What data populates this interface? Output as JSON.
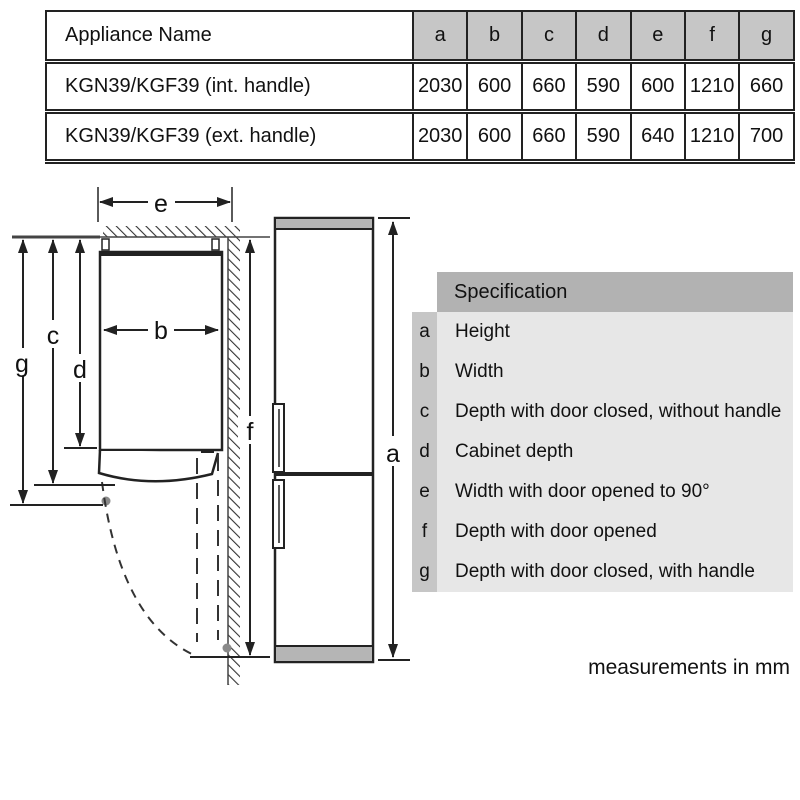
{
  "table": {
    "header": [
      "Appliance Name",
      "a",
      "b",
      "c",
      "d",
      "e",
      "f",
      "g"
    ],
    "rows": [
      {
        "name": "KGN39/KGF39 (int. handle)",
        "values": [
          "2030",
          "600",
          "660",
          "590",
          "600",
          "1210",
          "660"
        ]
      },
      {
        "name": "KGN39/KGF39 (ext. handle)",
        "values": [
          "2030",
          "600",
          "660",
          "590",
          "640",
          "1210",
          "700"
        ]
      }
    ]
  },
  "diagram": {
    "labels": {
      "a": "a",
      "b": "b",
      "c": "c",
      "d": "d",
      "e": "e",
      "f": "f",
      "g": "g"
    }
  },
  "specification": {
    "title": "Specification",
    "items": [
      {
        "key": "a",
        "label": "Height"
      },
      {
        "key": "b",
        "label": "Width"
      },
      {
        "key": "c",
        "label": "Depth with door closed, without handle"
      },
      {
        "key": "d",
        "label": "Cabinet depth"
      },
      {
        "key": "e",
        "label": "Width with door opened to 90°"
      },
      {
        "key": "f",
        "label": "Depth with door opened"
      },
      {
        "key": "g",
        "label": "Depth with door closed, with handle"
      }
    ]
  },
  "footer": {
    "note": "measurements in mm"
  },
  "colors": {
    "table_header_gray": "#c6c6c6",
    "spec_header_gray": "#b2b2b2",
    "spec_key_gray": "#c6c6c6",
    "spec_body_gray": "#e7e7e7",
    "fridge_trim_gray": "#b5b5b5",
    "line_black": "#222222"
  }
}
